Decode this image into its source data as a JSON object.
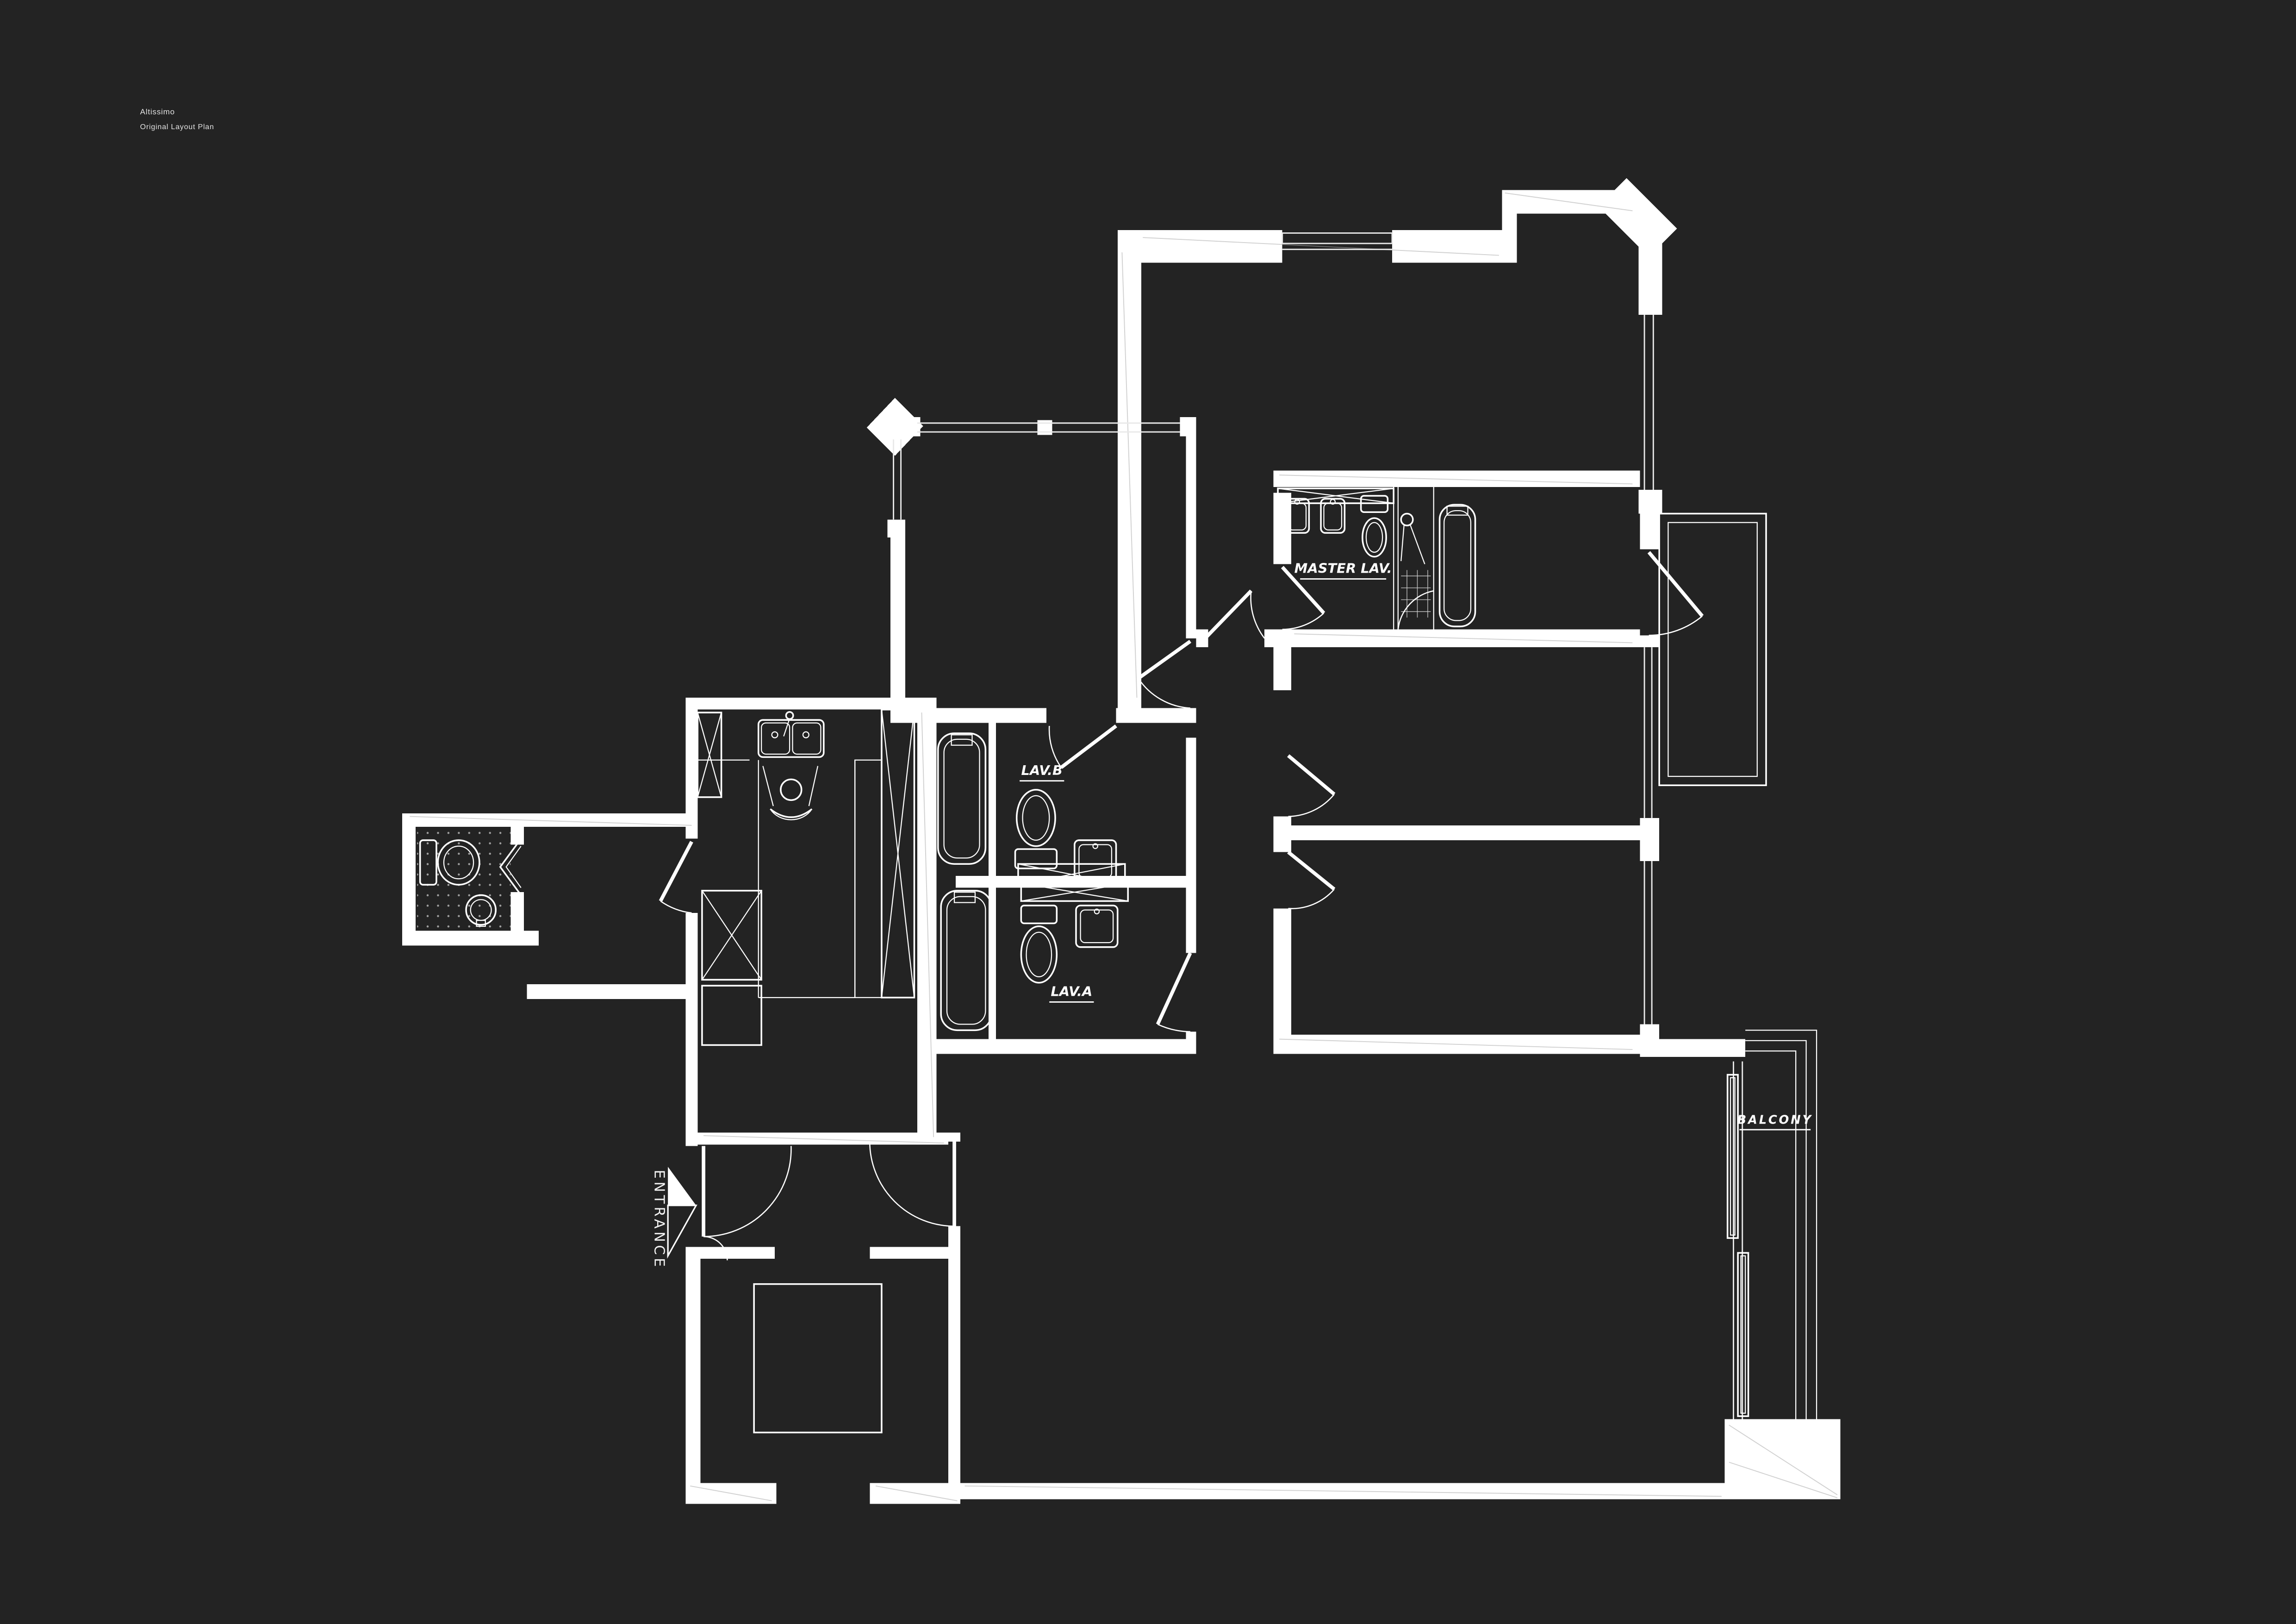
{
  "title": {
    "line1": "Altissimo",
    "line2": "Original Layout Plan"
  },
  "plan": {
    "labels": {
      "master_lav": "MASTER LAV.",
      "lav_b": "LAV.B",
      "lav_a": "LAV.A",
      "balcony": "BALCONY",
      "entrance": "ENTRANCE"
    },
    "legend": {
      "entrance_arrow": "arrow pointing right toward entrance door"
    }
  },
  "colors": {
    "background": "#232323",
    "linework": "#ffffff",
    "title_text": "#e3e3e3"
  }
}
